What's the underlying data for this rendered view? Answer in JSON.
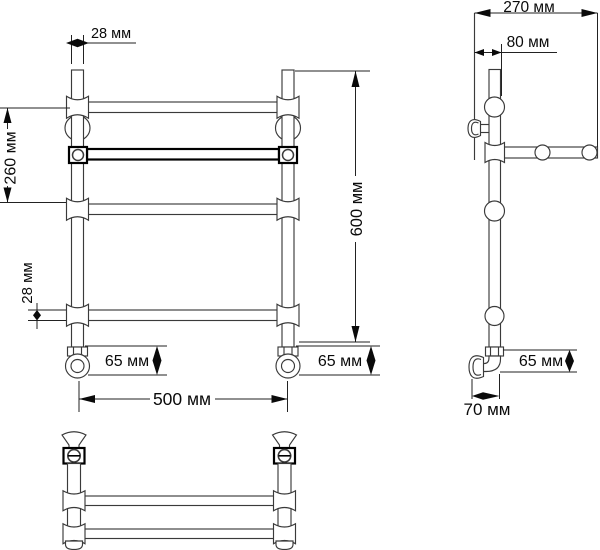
{
  "drawing": {
    "title": "towel-rail-dimension-drawing",
    "units": "мм",
    "front_view": {
      "post_width": "28 мм",
      "rail_spacing": "260 мм",
      "tube_diameter": "28 мм",
      "valve_height_left": "65 мм",
      "valve_height_right": "65 мм",
      "overall_width": "500 мм",
      "overall_height": "600 мм"
    },
    "side_view": {
      "depth": "270 мм",
      "wall_offset": "80 мм",
      "valve_height": "65 мм",
      "bottom_offset": "70 мм"
    },
    "colors": {
      "line": "#3a3a3a",
      "bold_line": "#000000",
      "background": "#ffffff"
    }
  }
}
